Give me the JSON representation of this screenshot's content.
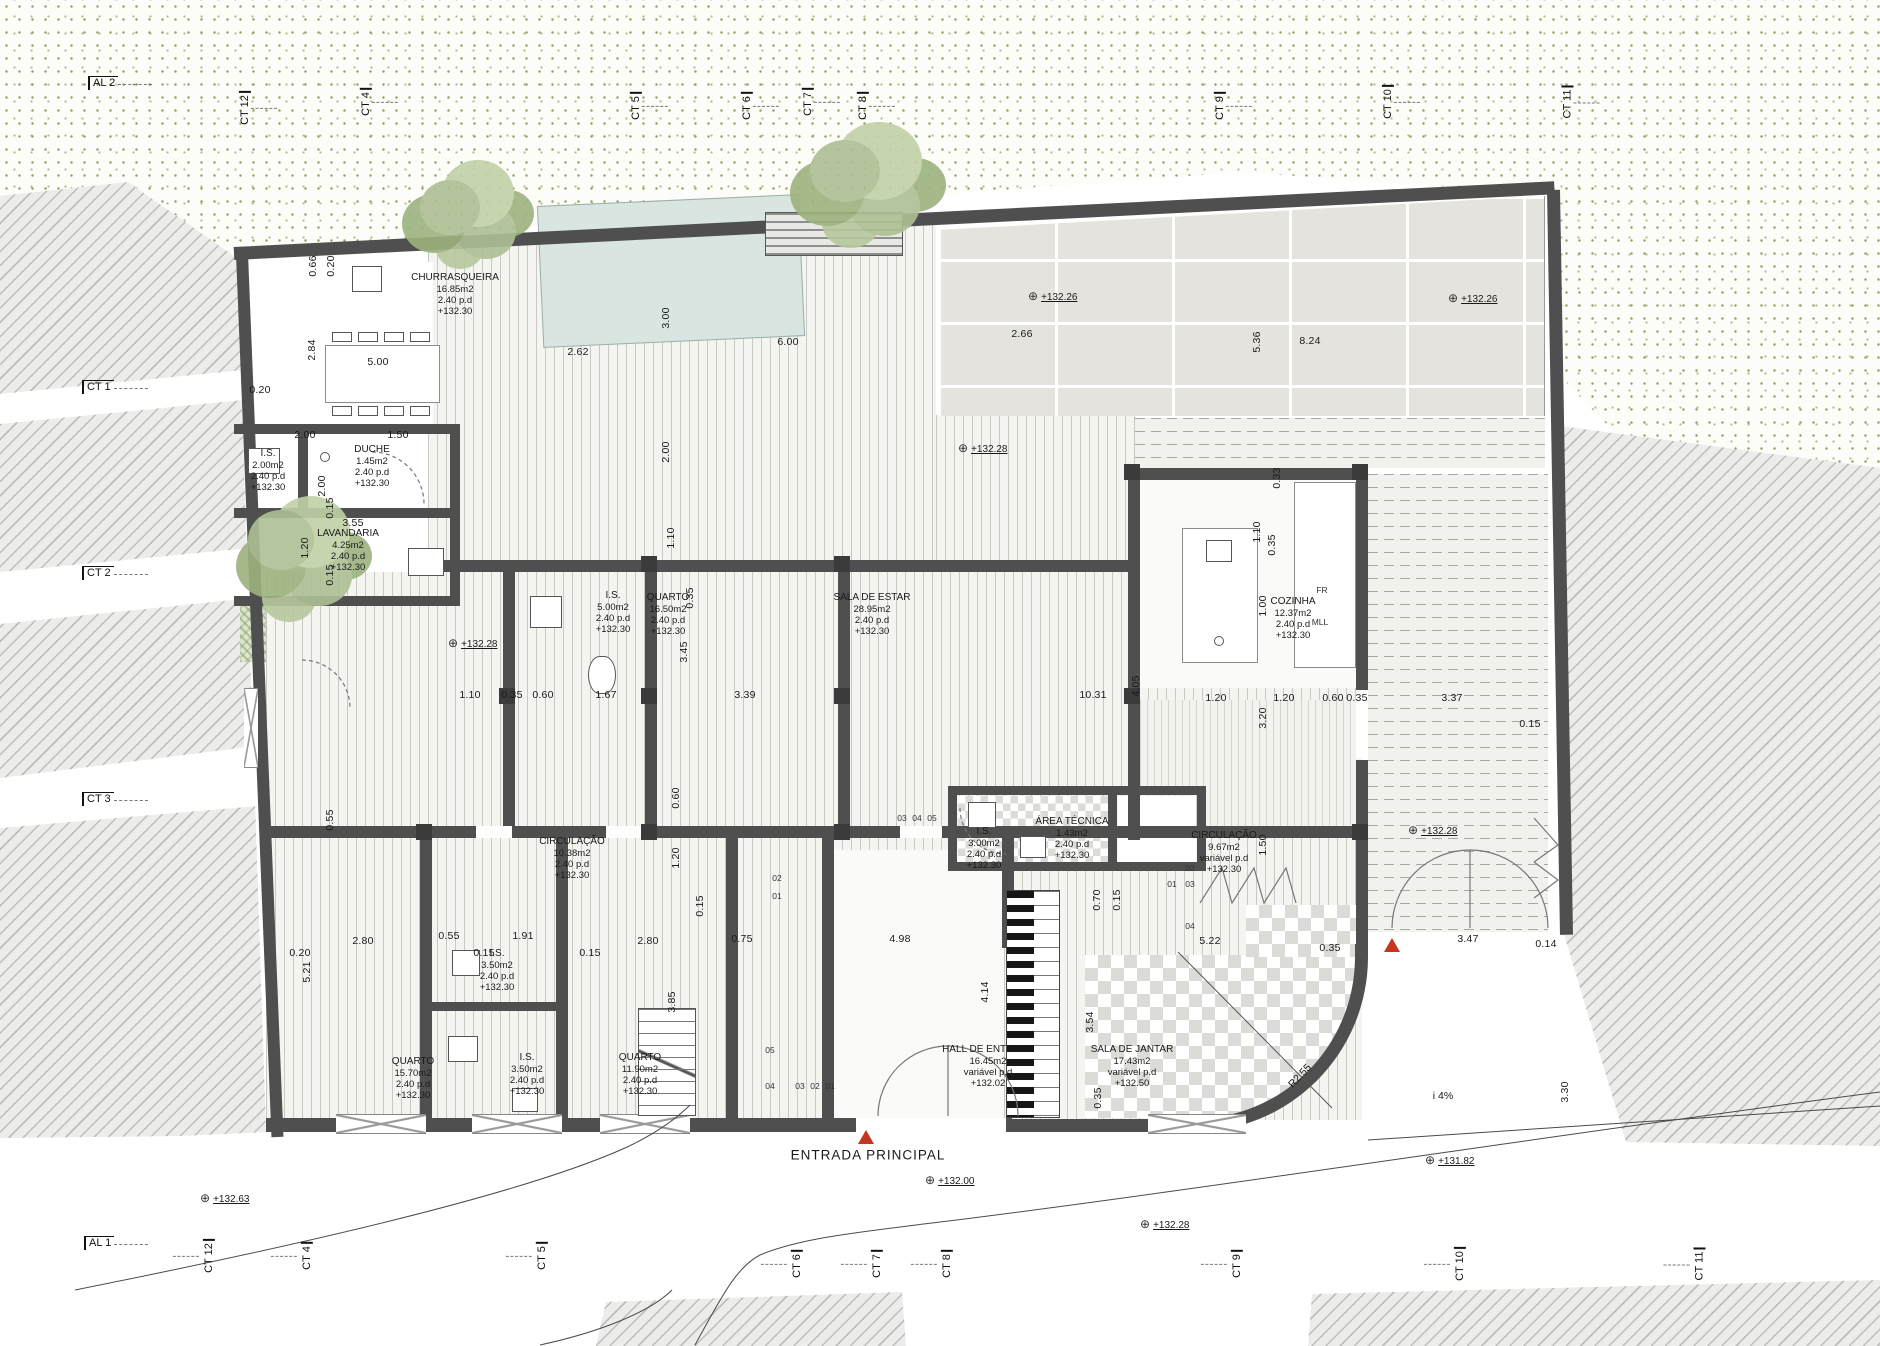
{
  "drawing": {
    "entrance_label": "ENTRADA  PRINCIPAL",
    "elevation_symbol": "⊕",
    "colors": {
      "wall": "#4f4f4f",
      "stipple_dot": "#98a066",
      "hatch_line": "#bdbdbb",
      "pool": "#d8e5e0",
      "tree": "#a9bc8e",
      "red_marker": "#c5351f",
      "tile": "#e4e3dd"
    }
  },
  "rooms": [
    {
      "name": "CHURRASQUEIRA",
      "area": "16.85m2",
      "height": "2.40  p.d",
      "level": "+132.30",
      "x": 455,
      "y": 272
    },
    {
      "name": "I.S.",
      "area": "2.00m2",
      "height": "2.40  p.d",
      "level": "+132.30",
      "x": 268,
      "y": 448
    },
    {
      "name": "DUCHE",
      "area": "1.45m2",
      "height": "2.40  p.d",
      "level": "+132.30",
      "x": 372,
      "y": 444
    },
    {
      "name": "LAVANDARIA",
      "area": "4.25m2",
      "height": "2.40  p.d",
      "level": "+132.30",
      "x": 348,
      "y": 528
    },
    {
      "name": "I.S.",
      "area": "5.00m2",
      "height": "2.40  p.d",
      "level": "+132.30",
      "x": 613,
      "y": 590
    },
    {
      "name": "QUARTO",
      "area": "16.50m2",
      "height": "2.40  p.d",
      "level": "+132.30",
      "x": 668,
      "y": 592
    },
    {
      "name": "SALA DE ESTAR",
      "area": "28.95m2",
      "height": "2.40  p.d",
      "level": "+132.30",
      "x": 872,
      "y": 592
    },
    {
      "name": "COZINHA",
      "area": "12.37m2",
      "height": "2.40  p.d",
      "level": "+132.30",
      "x": 1293,
      "y": 596
    },
    {
      "name": "CIRCULAÇÃO",
      "area": "10.38m2",
      "height": "2.40  p.d",
      "level": "+132.30",
      "x": 572,
      "y": 836
    },
    {
      "name": "I.S.",
      "area": "3.00m2",
      "height": "2.40  p.d",
      "level": "+132.30",
      "x": 984,
      "y": 826
    },
    {
      "name": "ÁREA TÉCNICA",
      "area": "1.43m2",
      "height": "2.40  p.d",
      "level": "+132.30",
      "x": 1072,
      "y": 816
    },
    {
      "name": "CIRCULAÇÃO",
      "area": "9.67m2",
      "height": "variável  p.d",
      "level": "+132.30",
      "x": 1224,
      "y": 830
    },
    {
      "name": "QUARTO",
      "area": "15.70m2",
      "height": "2.40  p.d",
      "level": "+132.30",
      "x": 413,
      "y": 1056
    },
    {
      "name": "I.S.",
      "area": "3.50m2",
      "height": "2.40  p.d",
      "level": "+132.30",
      "x": 497,
      "y": 948
    },
    {
      "name": "I.S.",
      "area": "3.50m2",
      "height": "2.40  p.d",
      "level": "+132.30",
      "x": 527,
      "y": 1052
    },
    {
      "name": "QUARTO",
      "area": "11.90m2",
      "height": "2.40  p.d",
      "level": "+132.30",
      "x": 640,
      "y": 1052
    },
    {
      "name": "HALL DE ENTRADA",
      "area": "16.45m2",
      "height": "variável  p.d",
      "level": "+132.02",
      "x": 988,
      "y": 1044
    },
    {
      "name": "SALA DE JANTAR",
      "area": "17.43m2",
      "height": "variável  p.d",
      "level": "+132.50",
      "x": 1132,
      "y": 1044
    }
  ],
  "grid_markers": {
    "top": [
      {
        "label": "AL 2",
        "x": 88,
        "y": 76,
        "o": "h"
      },
      {
        "label": "CT 12",
        "x": 228,
        "y": 102,
        "o": "v"
      },
      {
        "label": "CT 4",
        "x": 352,
        "y": 96,
        "o": "v"
      },
      {
        "label": "CT 5",
        "x": 622,
        "y": 100,
        "o": "v"
      },
      {
        "label": "CT 6",
        "x": 733,
        "y": 100,
        "o": "v"
      },
      {
        "label": "CT 7",
        "x": 794,
        "y": 96,
        "o": "v"
      },
      {
        "label": "CT 8",
        "x": 849,
        "y": 100,
        "o": "v"
      },
      {
        "label": "CT 9",
        "x": 1206,
        "y": 100,
        "o": "v"
      },
      {
        "label": "CT 10",
        "x": 1371,
        "y": 96,
        "o": "v"
      },
      {
        "label": "CT 11",
        "x": 1551,
        "y": 96,
        "o": "v"
      }
    ],
    "left": [
      {
        "label": "CT 1",
        "x": 82,
        "y": 380,
        "o": "h"
      },
      {
        "label": "CT 2",
        "x": 82,
        "y": 566,
        "o": "h"
      },
      {
        "label": "CT 3",
        "x": 82,
        "y": 792,
        "o": "h"
      },
      {
        "label": "AL 1",
        "x": 84,
        "y": 1236,
        "o": "h"
      }
    ],
    "bottom": [
      {
        "label": "CT 12",
        "x": 192,
        "y": 1250,
        "o": "v"
      },
      {
        "label": "CT 4",
        "x": 293,
        "y": 1250,
        "o": "v"
      },
      {
        "label": "CT 5",
        "x": 528,
        "y": 1250,
        "o": "v"
      },
      {
        "label": "CT 6",
        "x": 783,
        "y": 1258,
        "o": "v"
      },
      {
        "label": "CT 7",
        "x": 863,
        "y": 1258,
        "o": "v"
      },
      {
        "label": "CT 8",
        "x": 933,
        "y": 1258,
        "o": "v"
      },
      {
        "label": "CT 9",
        "x": 1223,
        "y": 1258,
        "o": "v"
      },
      {
        "label": "CT 10",
        "x": 1443,
        "y": 1258,
        "o": "v"
      },
      {
        "label": "CT 11",
        "x": 1683,
        "y": 1258,
        "o": "v"
      }
    ]
  },
  "elevations": [
    {
      "value": "+132.26",
      "x": 1028,
      "y": 296
    },
    {
      "value": "+132.26",
      "x": 1448,
      "y": 298
    },
    {
      "value": "+132.28",
      "x": 958,
      "y": 448
    },
    {
      "value": "+132.28",
      "x": 448,
      "y": 643
    },
    {
      "value": "+132.28",
      "x": 1408,
      "y": 830
    },
    {
      "value": "+132.63",
      "x": 200,
      "y": 1198
    },
    {
      "value": "+132.00",
      "x": 925,
      "y": 1180
    },
    {
      "value": "+132.28",
      "x": 1140,
      "y": 1224
    },
    {
      "value": "+131.82",
      "x": 1425,
      "y": 1160
    }
  ],
  "dimensions": [
    {
      "t": "0.20",
      "x": 260,
      "y": 390
    },
    {
      "t": "0.66",
      "x": 313,
      "y": 266,
      "r": 1
    },
    {
      "t": "0.20",
      "x": 331,
      "y": 266,
      "r": 1
    },
    {
      "t": "2.84",
      "x": 312,
      "y": 350,
      "r": 1
    },
    {
      "t": "5.00",
      "x": 378,
      "y": 362
    },
    {
      "t": "2.62",
      "x": 578,
      "y": 352
    },
    {
      "t": "6.00",
      "x": 788,
      "y": 342
    },
    {
      "t": "2.66",
      "x": 1022,
      "y": 334
    },
    {
      "t": "8.24",
      "x": 1310,
      "y": 341
    },
    {
      "t": "3.00",
      "x": 666,
      "y": 318,
      "r": 1
    },
    {
      "t": "5.36",
      "x": 1257,
      "y": 342,
      "r": 1
    },
    {
      "t": "2.00",
      "x": 666,
      "y": 452,
      "r": 1
    },
    {
      "t": "0.33",
      "x": 1277,
      "y": 478,
      "r": 1
    },
    {
      "t": "1.10",
      "x": 671,
      "y": 538,
      "r": 1
    },
    {
      "t": "1.10",
      "x": 1257,
      "y": 532,
      "r": 1
    },
    {
      "t": "0.35",
      "x": 1272,
      "y": 545,
      "r": 1
    },
    {
      "t": "1.00",
      "x": 1263,
      "y": 606,
      "r": 1
    },
    {
      "t": "3.20",
      "x": 1263,
      "y": 718,
      "r": 1
    },
    {
      "t": "1.50",
      "x": 1263,
      "y": 845,
      "r": 1
    },
    {
      "t": "2.00",
      "x": 305,
      "y": 435
    },
    {
      "t": "1.50",
      "x": 398,
      "y": 435
    },
    {
      "t": "2.00",
      "x": 322,
      "y": 486,
      "r": 1
    },
    {
      "t": "3.55",
      "x": 353,
      "y": 523
    },
    {
      "t": "0.15",
      "x": 330,
      "y": 508,
      "r": 1
    },
    {
      "t": "1.20",
      "x": 305,
      "y": 548,
      "r": 1
    },
    {
      "t": "0.15",
      "x": 330,
      "y": 575,
      "r": 1
    },
    {
      "t": "1.10",
      "x": 470,
      "y": 695
    },
    {
      "t": "0.35",
      "x": 512,
      "y": 695
    },
    {
      "t": "0.60",
      "x": 543,
      "y": 695
    },
    {
      "t": "1.67",
      "x": 606,
      "y": 695
    },
    {
      "t": "3.45",
      "x": 684,
      "y": 652,
      "r": 1
    },
    {
      "t": "3.39",
      "x": 745,
      "y": 695
    },
    {
      "t": "10.31",
      "x": 1093,
      "y": 695
    },
    {
      "t": "4.05",
      "x": 1136,
      "y": 686,
      "r": 1
    },
    {
      "t": "1.20",
      "x": 1216,
      "y": 698
    },
    {
      "t": "1.20",
      "x": 1284,
      "y": 698
    },
    {
      "t": "0.60",
      "x": 1333,
      "y": 698
    },
    {
      "t": "0.35",
      "x": 1357,
      "y": 698
    },
    {
      "t": "3.37",
      "x": 1452,
      "y": 698
    },
    {
      "t": "0.15",
      "x": 1530,
      "y": 724
    },
    {
      "t": "0.35",
      "x": 690,
      "y": 598,
      "r": 1
    },
    {
      "t": "0.60",
      "x": 676,
      "y": 798,
      "r": 1
    },
    {
      "t": "1.20",
      "x": 676,
      "y": 858,
      "r": 1
    },
    {
      "t": "0.15",
      "x": 700,
      "y": 906,
      "r": 1
    },
    {
      "t": "0.55",
      "x": 330,
      "y": 820,
      "r": 1
    },
    {
      "t": "0.20",
      "x": 300,
      "y": 953
    },
    {
      "t": "2.80",
      "x": 363,
      "y": 941
    },
    {
      "t": "0.55",
      "x": 449,
      "y": 936
    },
    {
      "t": "1.91",
      "x": 523,
      "y": 936
    },
    {
      "t": "0.15",
      "x": 484,
      "y": 953
    },
    {
      "t": "0.15",
      "x": 590,
      "y": 953
    },
    {
      "t": "2.80",
      "x": 648,
      "y": 941
    },
    {
      "t": "0.75",
      "x": 742,
      "y": 939
    },
    {
      "t": "4.98",
      "x": 900,
      "y": 939
    },
    {
      "t": "5.22",
      "x": 1210,
      "y": 941
    },
    {
      "t": "0.35",
      "x": 1330,
      "y": 948
    },
    {
      "t": "3.47",
      "x": 1468,
      "y": 939
    },
    {
      "t": "0.14",
      "x": 1546,
      "y": 944
    },
    {
      "t": "5.21",
      "x": 307,
      "y": 972,
      "r": 1
    },
    {
      "t": "3.85",
      "x": 672,
      "y": 1002,
      "r": 1
    },
    {
      "t": "4.14",
      "x": 985,
      "y": 992,
      "r": 1
    },
    {
      "t": "3.54",
      "x": 1090,
      "y": 1022,
      "r": 1
    },
    {
      "t": "0.35",
      "x": 1098,
      "y": 1098,
      "r": 1
    },
    {
      "t": "3.30",
      "x": 1565,
      "y": 1092,
      "r": 1
    },
    {
      "t": "0.70",
      "x": 1097,
      "y": 900,
      "r": 1
    },
    {
      "t": "0.15",
      "x": 1117,
      "y": 900,
      "r": 1
    }
  ],
  "annotations": [
    {
      "t": "ENTRADA  PRINCIPAL",
      "x": 868,
      "y": 1155,
      "cls": "big"
    },
    {
      "t": "i  4%",
      "x": 1443,
      "y": 1096
    },
    {
      "t": "R2.55",
      "x": 1300,
      "y": 1076,
      "rot": -47
    },
    {
      "t": "FR",
      "x": 1322,
      "y": 590,
      "cls": "tiny"
    },
    {
      "t": "MLL",
      "x": 1320,
      "y": 622,
      "cls": "tiny"
    },
    {
      "t": "02",
      "x": 777,
      "y": 878,
      "cls": "tiny"
    },
    {
      "t": "01",
      "x": 777,
      "y": 896,
      "cls": "tiny"
    },
    {
      "t": "05",
      "x": 770,
      "y": 1050,
      "cls": "tiny"
    },
    {
      "t": "04",
      "x": 770,
      "y": 1086,
      "cls": "tiny"
    },
    {
      "t": "03",
      "x": 800,
      "y": 1086,
      "cls": "tiny"
    },
    {
      "t": "02",
      "x": 815,
      "y": 1086,
      "cls": "tiny"
    },
    {
      "t": "01",
      "x": 830,
      "y": 1086,
      "cls": "tiny"
    },
    {
      "t": "02",
      "x": 1190,
      "y": 868,
      "cls": "tiny"
    },
    {
      "t": "03",
      "x": 1190,
      "y": 884,
      "cls": "tiny"
    },
    {
      "t": "01",
      "x": 1172,
      "y": 884,
      "cls": "tiny"
    },
    {
      "t": "04",
      "x": 1190,
      "y": 926,
      "cls": "tiny"
    },
    {
      "t": "03",
      "x": 902,
      "y": 818,
      "cls": "tiny"
    },
    {
      "t": "04",
      "x": 917,
      "y": 818,
      "cls": "tiny"
    },
    {
      "t": "05",
      "x": 932,
      "y": 818,
      "cls": "tiny"
    }
  ]
}
